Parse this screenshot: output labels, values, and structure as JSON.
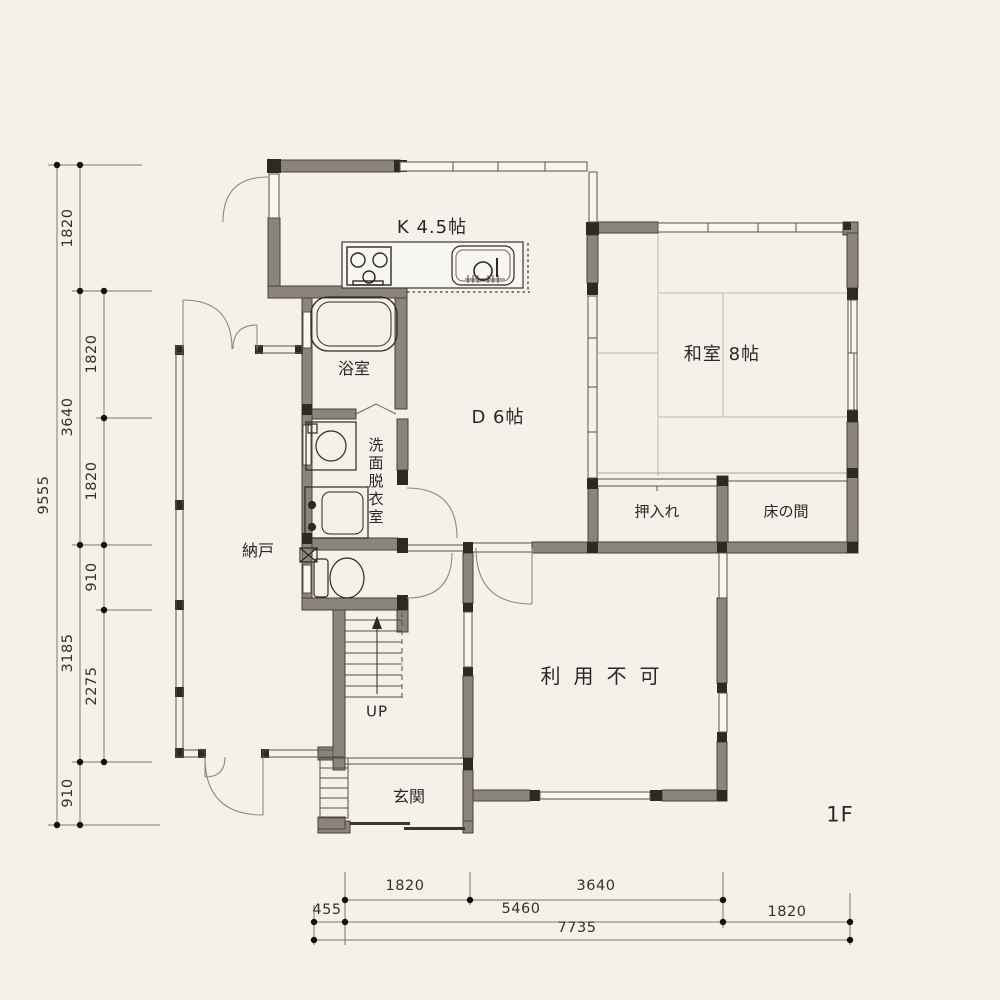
{
  "page": {
    "floor_label": "1F",
    "type": "architectural floor plan (Japanese madori-zu), 1st floor"
  },
  "rooms": {
    "kitchen": "K 4.5帖",
    "dining": "D 6帖",
    "washitsu": "和室 8帖",
    "bath": "浴室",
    "washroom": "洗面脱衣室",
    "storage": "納戸",
    "oshiire": "押入れ",
    "tokonoma": "床の間",
    "unusable": "利用不可",
    "genkan": "玄関",
    "stairs_up": "UP"
  },
  "dimensions": {
    "left_total": "9555",
    "left_outer": [
      "1820",
      "3640",
      "3185",
      "910"
    ],
    "left_inner": [
      "1820",
      "1820",
      "910",
      "2275"
    ],
    "bottom_row1": [
      "1820",
      "3640"
    ],
    "bottom_row2": [
      "455",
      "5460",
      "1820"
    ],
    "bottom_total": "7735"
  },
  "colors": {
    "paper": "#f2efe8",
    "wall_fill": "#8c8478",
    "post_fill": "#2d2923",
    "thin_line": "#57524a",
    "arc_line": "#8f8a7f",
    "dim_line": "#7d776c",
    "text": "#2b2823"
  },
  "icons": {
    "stove-icon": "three burner circles",
    "sink-icon": "rounded basin with faucet and rack",
    "bathtub-icon": "double rounded rectangle tub",
    "washing-machine-icon": "square with drum circle",
    "vanity-icon": "cabinet with basin",
    "toilet-icon": "tank and bowl ellipse",
    "stairs-icon": "treads with up arrow",
    "entry-steps-icon": "striped step strip",
    "door-arc-icon": "quarter-circle swing arc"
  }
}
